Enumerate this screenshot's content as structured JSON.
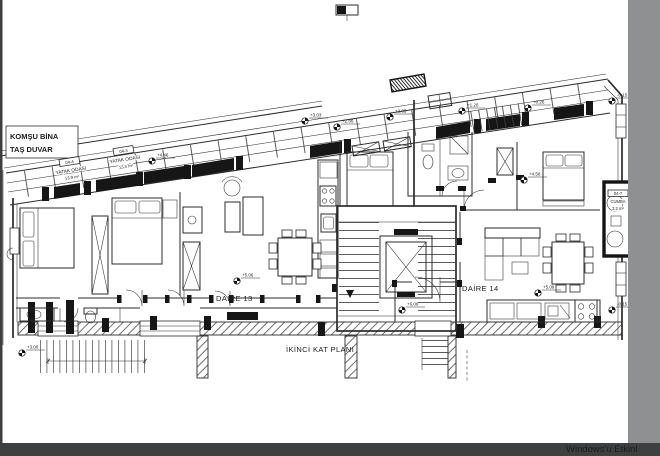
{
  "page": {
    "watermark": "Windows'u Etkinl",
    "colors": {
      "canvas": "#ffffff",
      "ink": "#2b2b2b",
      "right_band": "#8f9092",
      "bottom_band": "#3d3f41",
      "left_edge": "#3d3f41",
      "watermark": "#a7abaf"
    }
  },
  "plan": {
    "title": "İKİNCİ KAT PLANI",
    "neighbor_wall_note": {
      "line1": "KOMŞU BİNA",
      "line2": "TAŞ DUVAR"
    },
    "apartments": [
      {
        "name": "DAİRE 13"
      },
      {
        "name": "DAİRE 14"
      }
    ],
    "rooms": [
      {
        "code": "04-4",
        "name": "YATAK ODASI",
        "area": "13.9 m²"
      },
      {
        "code": "04-3",
        "name": "YATAK ODASI",
        "area": "13.5 m²"
      },
      {
        "code": "04-7",
        "name": "CUMBA",
        "area": "3.2 m²"
      }
    ],
    "levels": {
      "facade_1": "+3.03",
      "facade_2": "+2.86",
      "facade_3": "+2.85",
      "facade_4": "+1.20",
      "facade_5": "+0.26",
      "street_top_right": "-0.15",
      "bedroom_left": "+4.46",
      "bedroom_right": "+4.58",
      "daire13_floor": "+5.06",
      "daire14_floor": "+5.09",
      "entry_hall": "+6.09",
      "terrace_left": "+3.00",
      "street_right_side": "-0.15"
    }
  }
}
